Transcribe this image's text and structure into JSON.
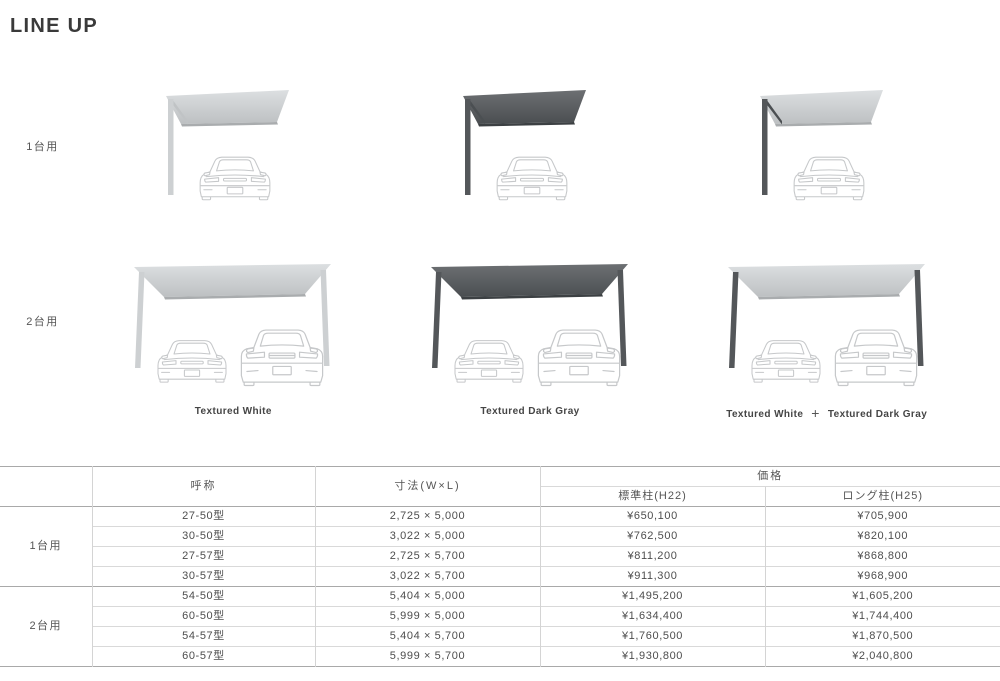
{
  "page": {
    "title": "LINE UP"
  },
  "lineup": {
    "row_labels": [
      "1台用",
      "2台用"
    ],
    "variants": [
      {
        "caption": "Textured White"
      },
      {
        "caption": "Textured Dark Gray"
      },
      {
        "caption_left": "Textured White",
        "caption_plus": "+",
        "caption_right": "Textured Dark Gray"
      }
    ],
    "colors": {
      "roof_white_top": "#dcdfe1",
      "roof_white_bottom": "#bdc0c2",
      "roof_dark_top": "#6d7073",
      "roof_dark_bottom": "#4a4e51",
      "post_white": "#cdd0d2",
      "post_dark": "#54575a",
      "car_outline": "#c6c8ca"
    }
  },
  "spec_table": {
    "headers": {
      "name": "呼称",
      "size": "寸法(W×L)",
      "price": "価格",
      "standard": "標準柱(H22)",
      "long": "ロング柱(H25)"
    },
    "groups": [
      {
        "label": "1台用",
        "rows": [
          {
            "name": "27-50型",
            "size": "2,725 × 5,000",
            "standard": "¥650,100",
            "long": "¥705,900"
          },
          {
            "name": "30-50型",
            "size": "3,022 × 5,000",
            "standard": "¥762,500",
            "long": "¥820,100"
          },
          {
            "name": "27-57型",
            "size": "2,725 × 5,700",
            "standard": "¥811,200",
            "long": "¥868,800"
          },
          {
            "name": "30-57型",
            "size": "3,022 × 5,700",
            "standard": "¥911,300",
            "long": "¥968,900"
          }
        ]
      },
      {
        "label": "2台用",
        "rows": [
          {
            "name": "54-50型",
            "size": "5,404 × 5,000",
            "standard": "¥1,495,200",
            "long": "¥1,605,200"
          },
          {
            "name": "60-50型",
            "size": "5,999 × 5,000",
            "standard": "¥1,634,400",
            "long": "¥1,744,400"
          },
          {
            "name": "54-57型",
            "size": "5,404 × 5,700",
            "standard": "¥1,760,500",
            "long": "¥1,870,500"
          },
          {
            "name": "60-57型",
            "size": "5,999 × 5,700",
            "standard": "¥1,930,800",
            "long": "¥2,040,800"
          }
        ]
      }
    ]
  }
}
